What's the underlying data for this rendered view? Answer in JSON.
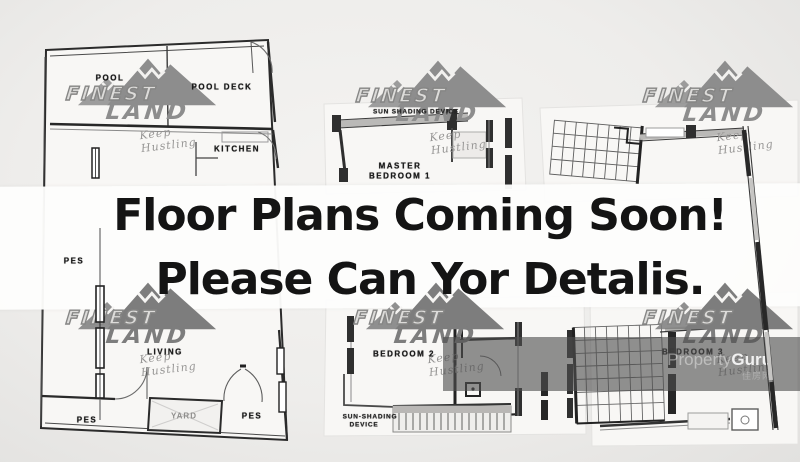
{
  "banner": {
    "line1": "Floor Plans Coming Soon!",
    "line2": "Please Can Yor Detalis.",
    "background": "#fdfdfc",
    "text_color": "#141414"
  },
  "watermark": {
    "brand_top": "FINEST",
    "brand_bottom": "LAND",
    "slogan": "Keep Hustling",
    "color": "#8d8d8d"
  },
  "property_guru": {
    "brand_light": "Property",
    "brand_bold": "Guru",
    "subtext": "佳房网",
    "band_color": "#4f4f4f"
  },
  "floor_plan_labels": {
    "pool": "POOL",
    "pool_deck": "POOL DECK",
    "kitchen": "KITCHEN",
    "sun_shading_top": "SUN SHADING DEVICE",
    "master_bedroom_line1": "MASTER",
    "master_bedroom_line2": "BEDROOM 1",
    "pes_upper": "PES",
    "living": "LIVING",
    "pes_bottom_left": "PES",
    "yard": "YARD",
    "pes_bottom_right": "PES",
    "bedroom2": "BEDROOM 2",
    "sun_shading_line1": "SUN-SHADING",
    "sun_shading_line2": "DEVICE",
    "bedroom3": "BEDROOM 3"
  }
}
